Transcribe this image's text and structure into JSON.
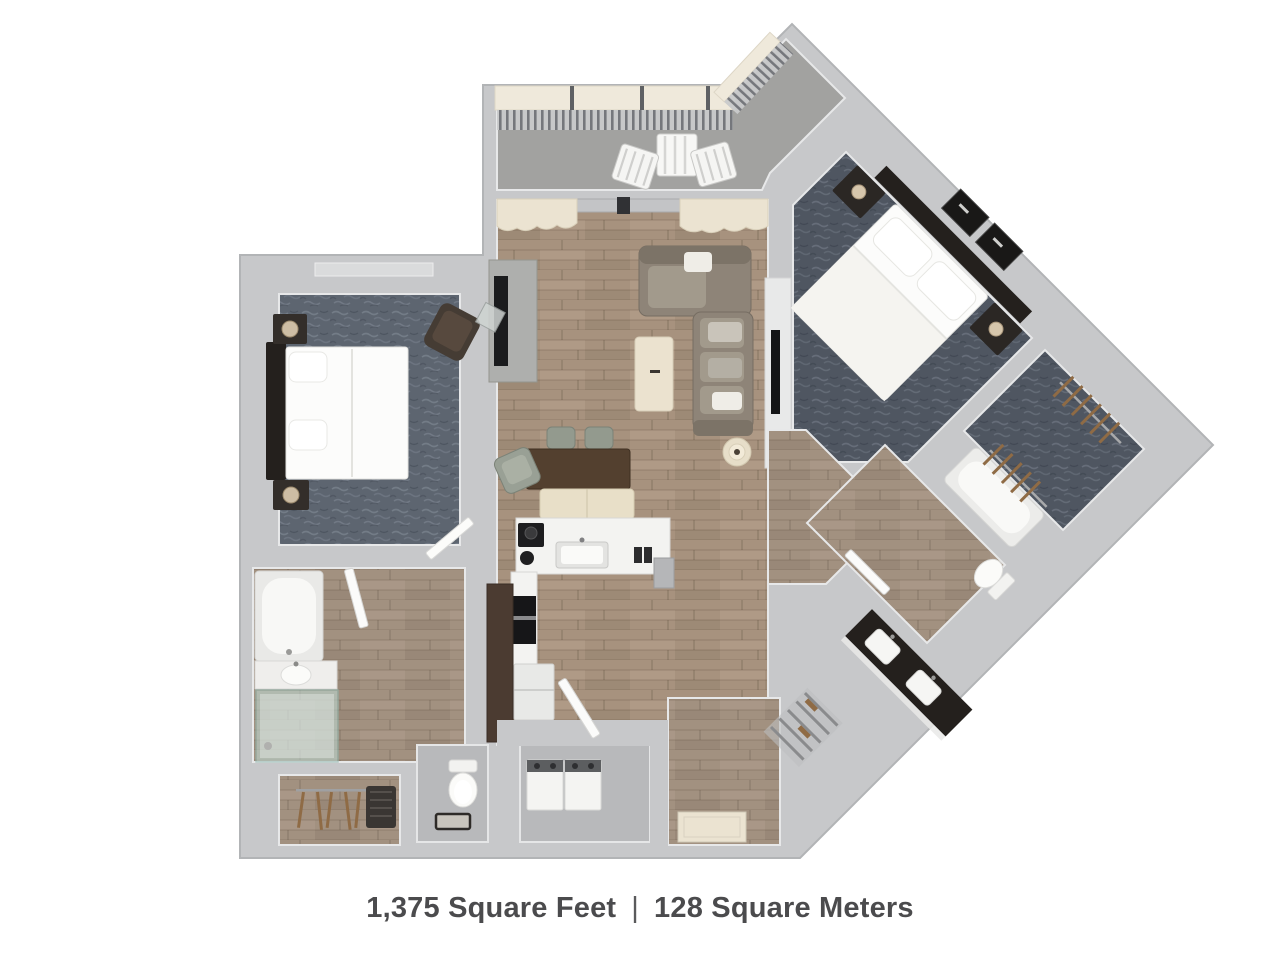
{
  "caption": {
    "area_sqft": "1,375 Square Feet",
    "separator": "|",
    "area_sqm": "128 Square Meters"
  },
  "palette": {
    "background": "#ffffff",
    "wall": "#c7c8ca",
    "wall_edge": "#b2b4b6",
    "carpet": "#5d6570",
    "carpet_dark": "#4f5661",
    "wood": "#a7927e",
    "wood_gray": "#a29180",
    "balcony_floor": "#a2a2a0",
    "tile_gray": "#b8b9bb",
    "furniture_dark": "#24201d",
    "furniture_brown": "#53402f",
    "cream": "#ebe3d1",
    "shower_glass": "#bcd6cf",
    "hanger_brown": "#8f6b45",
    "text": "#4b4b4d"
  }
}
